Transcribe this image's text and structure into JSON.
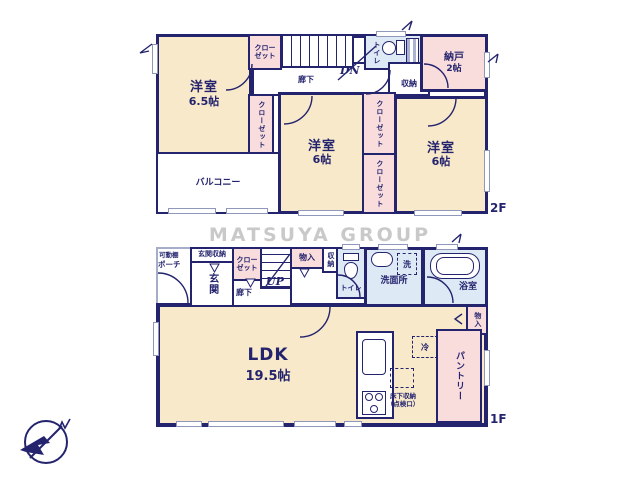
{
  "watermark": "MATSUYA GROUP",
  "colors": {
    "wall": "#24246e",
    "room": "#f8e9ca",
    "closet": "#f9dcdc",
    "wet": "#dde9f5",
    "watermark": "#c9c9c9",
    "winframe": "#8f97bb"
  },
  "f2": {
    "floor_label": "2F",
    "bed1_name": "洋室",
    "bed1_size": "6.5帖",
    "closet_top": "クローゼット",
    "closet_left": "クローゼット",
    "balcony": "バルコニー",
    "hall": "廊下",
    "dn": "DN",
    "toilet": "トイレ",
    "storage": "収納",
    "nando_name": "納戸",
    "nando_size": "2帖",
    "bed2_name": "洋室",
    "bed2_size": "6帖",
    "closet_mid": "クローゼット",
    "closet_bot": "クローゼット",
    "bed3_name": "洋室",
    "bed3_size": "6帖"
  },
  "f1": {
    "floor_label": "1F",
    "shelf": "可動棚",
    "porch": "ポーチ",
    "entry_storage": "玄関収納",
    "closet": "クローゼット",
    "entry": "玄関",
    "hall": "廊下",
    "up": "UP",
    "monoire": "物入",
    "shuno": "収納",
    "toilet": "トイレ",
    "washroom": "洗面所",
    "washer": "洗",
    "bath": "浴室",
    "monoire2": "物入",
    "ldk_name": "LDK",
    "ldk_size": "19.5帖",
    "fridge": "冷",
    "underfloor1": "床下収納",
    "underfloor2": "（点検口）",
    "pantry": "パントリー"
  }
}
